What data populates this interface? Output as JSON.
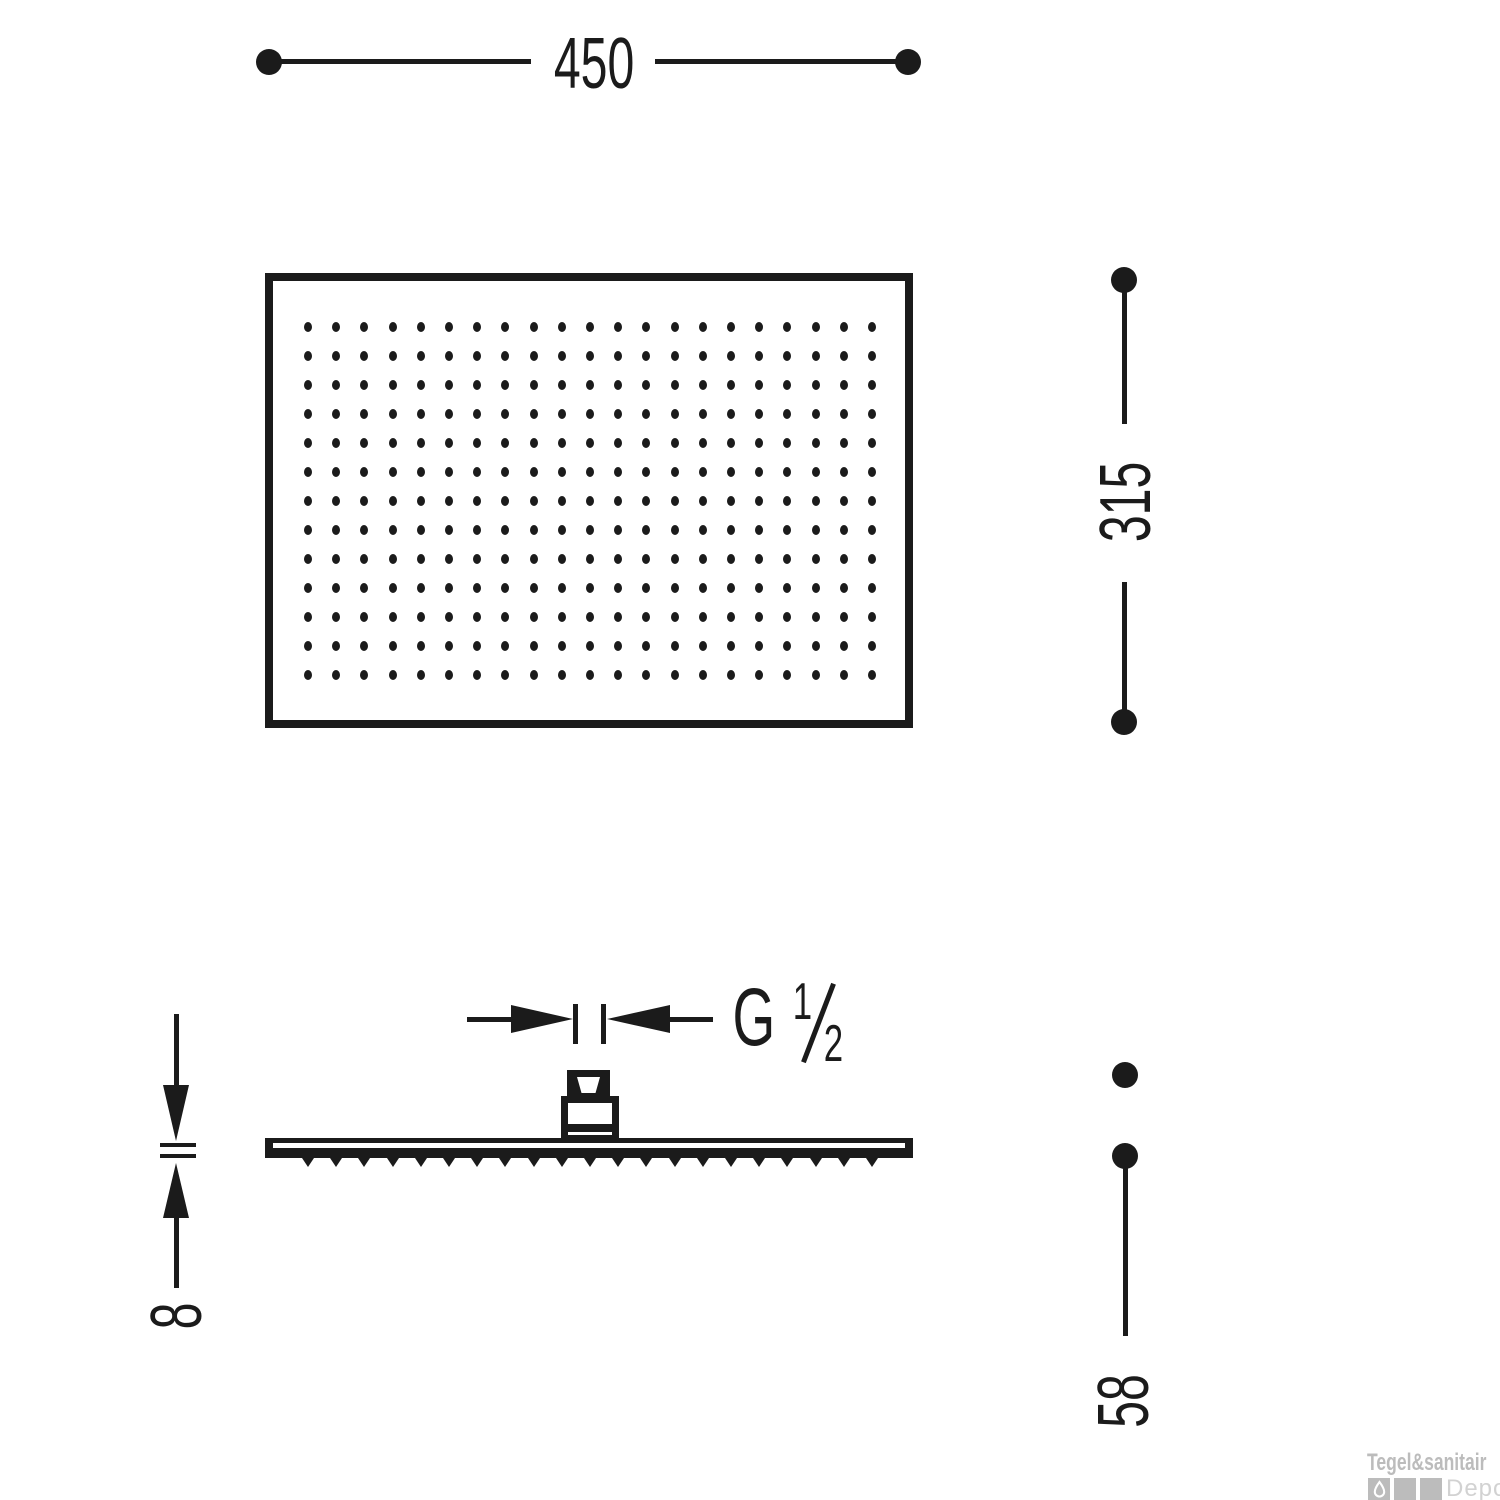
{
  "dimensions": {
    "width_mm": "450",
    "height_mm": "315",
    "plate_thickness_mm": "8",
    "total_depth_mm": "58"
  },
  "thread": {
    "letter": "G",
    "fraction_numerator": "1",
    "fraction_denominator": "2"
  },
  "front_view": {
    "spray_grid": {
      "columns": 21,
      "rows": 13
    }
  },
  "side_view": {
    "nozzle_count": 21
  },
  "watermark": {
    "brand": "Tegel&sanitair",
    "sub_brand": "Depot"
  },
  "colors": {
    "line_color": "#1b1b1b",
    "watermark_gray": "#bcbcbc",
    "watermark_light_gray": "#d2d2d2"
  }
}
